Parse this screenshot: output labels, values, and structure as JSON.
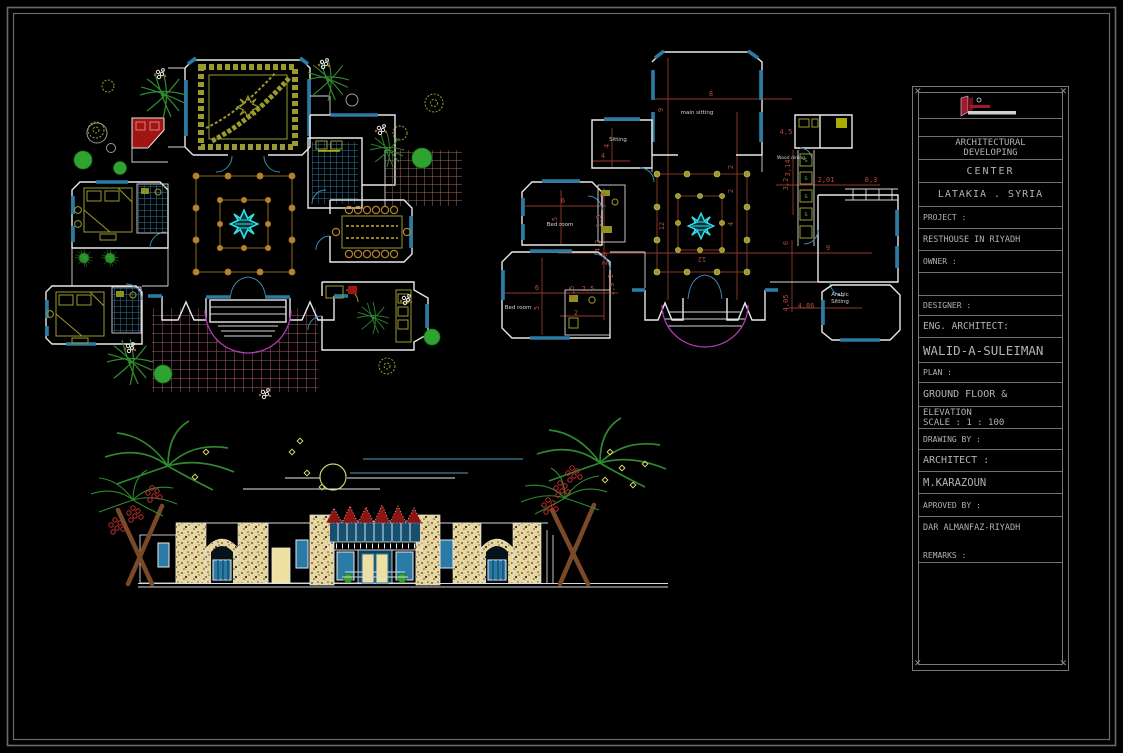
{
  "sheet": {
    "background": "#000000",
    "border_color": "#6a6a6a"
  },
  "palette": {
    "wall": "#e9e9e9",
    "window": "#2b7ba3",
    "dimension": "#a0392e",
    "furniture_olive": "#9a9a2e",
    "column_tan": "#b5812b",
    "fountain_cyan": "#2fe0e8",
    "entrance_magenta": "#b23ab2",
    "paving_brown": "#9a6a4e",
    "paving_rose": "#a65a66",
    "tile_blue": "#2b7ba3",
    "stone_tan": "#e7d6a0",
    "crest_red": "#8e1414",
    "tree_green": "#2fa32f",
    "logo_red": "#a11830",
    "title_text": "#b2b2b2"
  },
  "right_plan": {
    "labels": {
      "top_room": "main sitting",
      "sitting": "Sitting",
      "wood": "Wood dining",
      "bed1": "Bed room",
      "bed2": "Bed room",
      "arabic1": "Arabic",
      "arabic2": "Sitting"
    },
    "dims": [
      "8",
      "9",
      "4",
      "4",
      "4,5",
      "3,14",
      "3,2",
      "2,01",
      "0,3",
      "6",
      "5",
      "2",
      "1,5",
      "12",
      "4",
      "2",
      "2",
      "12",
      "9",
      "6",
      "4,2",
      "2,8",
      "6",
      "5",
      "2,5",
      "1,5",
      "1,9",
      "2",
      "2",
      "4,05",
      "4,86"
    ]
  },
  "title_block": {
    "header_line1": "ARCHITECTURAL",
    "header_line2": "DEVELOPING",
    "center": "CENTER",
    "location": "LATAKIA  .  SYRIA",
    "project_label": "PROJECT :",
    "project_value": "RESTHOUSE IN RIYADH",
    "owner_label": "OWNER :",
    "designer_label": "DESIGNER :",
    "eng_label": "ENG. ARCHITECT:",
    "eng_value": "WALID-A-SULEIMAN",
    "plan_label": "PLAN :",
    "plan_value_line1": "GROUND  FLOOR &",
    "plan_value_line2": "ELEVATION",
    "plan_scale": "SCALE : 1 : 100",
    "drawing_by_label": "DRAWING BY :",
    "drawing_by_role": "ARCHITECT :",
    "drawing_by_value": "M.KARAZOUN",
    "approved_label": "APROVED BY :",
    "approved_value": "DAR ALMANFAZ-RIYADH",
    "remarks_label": "REMARKS :"
  }
}
